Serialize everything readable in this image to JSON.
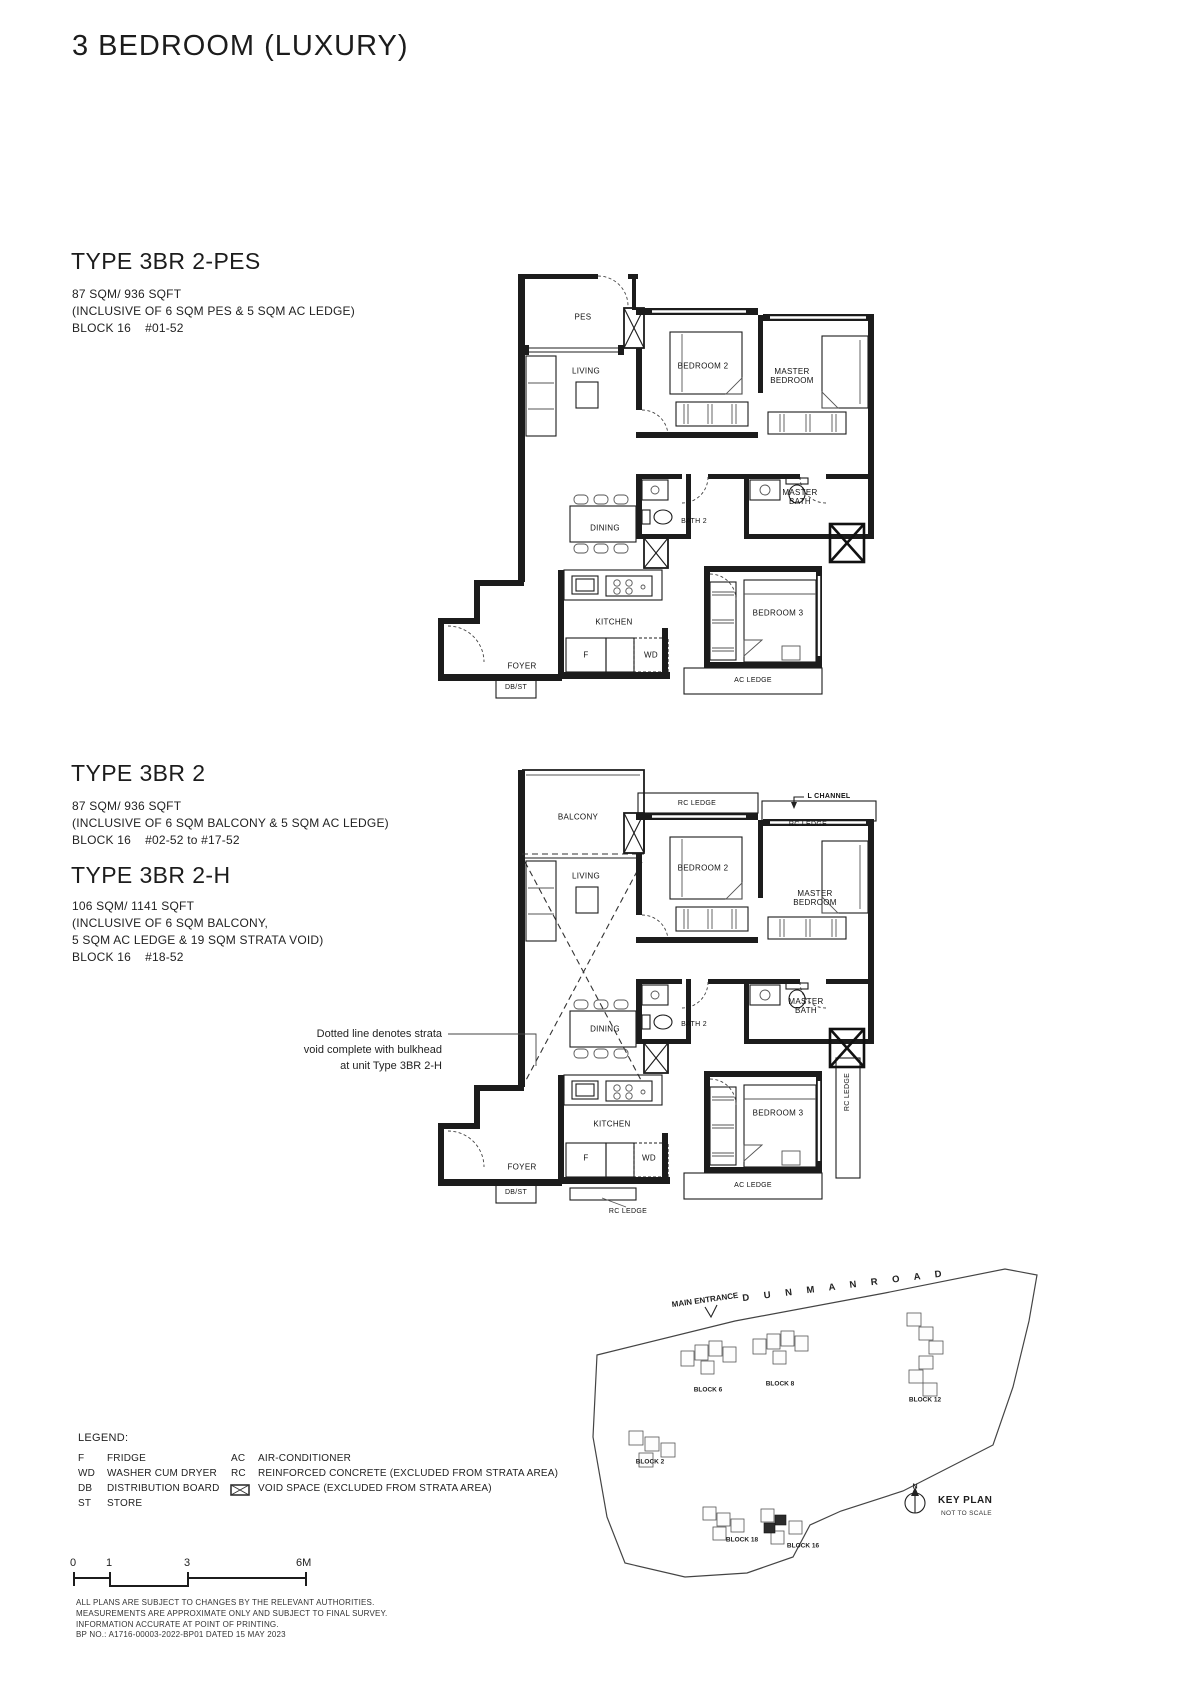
{
  "title": "3 BEDROOM (LUXURY)",
  "types": {
    "t1": {
      "name": "TYPE 3BR 2-PES",
      "area": "87 SQM/ 936 SQFT",
      "incl1": "(INCLUSIVE OF 6 SQM PES & 5 SQM AC LEDGE)",
      "loc": "BLOCK 16    #01-52"
    },
    "t2": {
      "name": "TYPE 3BR 2",
      "area": "87 SQM/ 936 SQFT",
      "incl1": "(INCLUSIVE OF 6 SQM BALCONY & 5 SQM AC LEDGE)",
      "loc": "BLOCK 16    #02-52 to #17-52"
    },
    "t3": {
      "name": "TYPE 3BR 2-H",
      "area": "106 SQM/ 1141 SQFT",
      "incl1": "(INCLUSIVE OF 6 SQM BALCONY,",
      "incl2": "5 SQM AC LEDGE & 19 SQM STRATA VOID)",
      "loc": "BLOCK 16    #18-52"
    }
  },
  "annotation": {
    "l1": "Dotted line denotes strata",
    "l2": "void complete with bulkhead",
    "l3": "at unit Type 3BR 2-H"
  },
  "plan1": {
    "pes": "PES",
    "living": "LIVING",
    "bedroom2": "BEDROOM 2",
    "master_bedroom": "MASTER BEDROOM",
    "master_bath": "MASTER BATH",
    "dining": "DINING",
    "bath2": "BATH 2",
    "kitchen": "KITCHEN",
    "fridge": "F",
    "wd": "WD",
    "foyer": "FOYER",
    "dbst": "DB/ST",
    "bedroom3": "BEDROOM 3",
    "ac_ledge": "AC LEDGE"
  },
  "plan2": {
    "balcony": "BALCONY",
    "rc_ledge_top": "RC LEDGE",
    "l_channel": "L CHANNEL",
    "rc_ledge_right": "RC LEDGE",
    "living": "LIVING",
    "bedroom2": "BEDROOM 2",
    "master_bedroom": "MASTER BEDROOM",
    "master_bath": "MASTER BATH",
    "dining": "DINING",
    "bath2": "BATH 2",
    "kitchen": "KITCHEN",
    "fridge": "F",
    "wd": "WD",
    "foyer": "FOYER",
    "dbst": "DB/ST",
    "bedroom3": "BEDROOM 3",
    "rc_ledge_side": "RC LEDGE",
    "ac_ledge": "AC LEDGE",
    "rc_ledge_bottom": "RC LEDGE"
  },
  "legend": {
    "heading": "LEGEND:",
    "col1": [
      {
        "abbr": "F",
        "term": "FRIDGE"
      },
      {
        "abbr": "WD",
        "term": "WASHER CUM DRYER"
      },
      {
        "abbr": "DB",
        "term": "DISTRIBUTION BOARD"
      },
      {
        "abbr": "ST",
        "term": "STORE"
      }
    ],
    "col2": [
      {
        "abbr": "AC",
        "term": "AIR-CONDITIONER"
      },
      {
        "abbr": "RC",
        "term": "REINFORCED CONCRETE (EXCLUDED FROM STRATA AREA)"
      },
      {
        "abbr": "",
        "term": "VOID SPACE (EXCLUDED FROM STRATA AREA)"
      }
    ]
  },
  "scale": {
    "n0": "0",
    "n1": "1",
    "n3": "3",
    "n6": "6M"
  },
  "disclaimer": {
    "l1": "ALL PLANS ARE SUBJECT TO CHANGES BY THE RELEVANT AUTHORITIES.",
    "l2": "MEASUREMENTS ARE APPROXIMATE ONLY AND SUBJECT TO FINAL SURVEY.",
    "l3": "INFORMATION ACCURATE AT POINT OF PRINTING.",
    "l4": "BP NO.: A1716-00003-2022-BP01 DATED 15 MAY 2023"
  },
  "keyplan": {
    "main_entrance": "MAIN ENTRANCE",
    "road": "D U N M A N   R O A D",
    "b2": "BLOCK 2",
    "b6": "BLOCK 6",
    "b8": "BLOCK 8",
    "b12": "BLOCK 12",
    "b16": "BLOCK 16",
    "b18": "BLOCK 18",
    "north": "N",
    "title": "KEY PLAN",
    "note": "NOT TO SCALE"
  }
}
